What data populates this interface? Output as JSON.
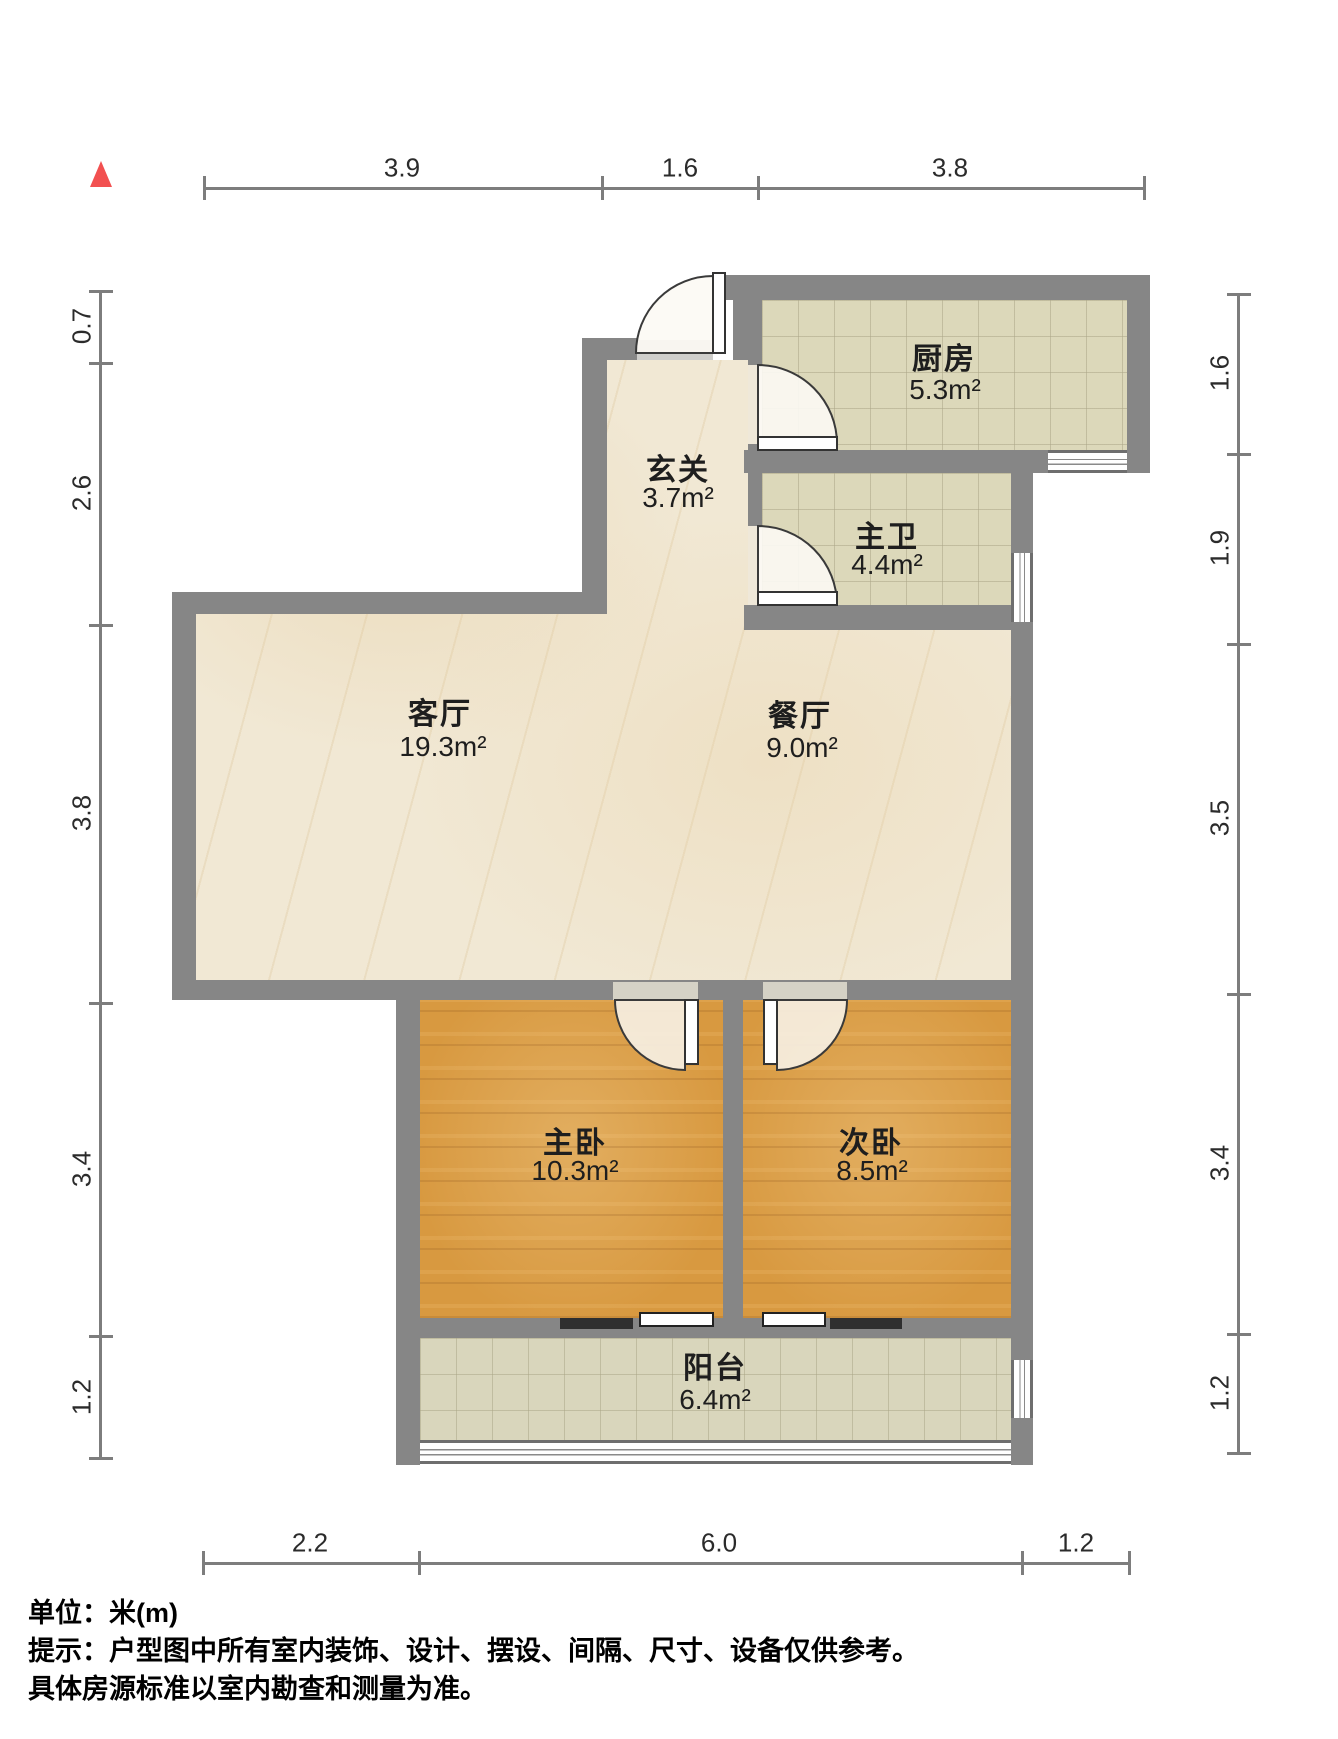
{
  "title": "户型图",
  "unit_note": "单位：米(m)",
  "rooms": [
    {
      "id": "entry",
      "name": "玄关",
      "area": "3.7m²"
    },
    {
      "id": "kitchen",
      "name": "厨房",
      "area": "5.3m²"
    },
    {
      "id": "master-bath",
      "name": "主卫",
      "area": "4.4m²"
    },
    {
      "id": "living-room",
      "name": "客厅",
      "area": "19.3m²"
    },
    {
      "id": "dining-room",
      "name": "餐厅",
      "area": "9.0m²"
    },
    {
      "id": "master-bedroom",
      "name": "主卧",
      "area": "10.3m²"
    },
    {
      "id": "second-bedroom",
      "name": "次卧",
      "area": "8.5m²"
    },
    {
      "id": "balcony",
      "name": "阳台",
      "area": "6.4m²"
    }
  ],
  "dimensions": {
    "top": [
      "3.9",
      "1.6",
      "3.8"
    ],
    "bottom": [
      "2.2",
      "6.0",
      "1.2"
    ],
    "left": [
      "0.7",
      "2.6",
      "3.8",
      "3.4",
      "1.2"
    ],
    "right": [
      "1.6",
      "1.9",
      "3.5",
      "3.4",
      "1.2"
    ]
  },
  "footer": {
    "line1": "单位：米(m)",
    "line2": "提示：户型图中所有室内装饰、设计、摆设、间隔、尺寸、设备仅供参考。",
    "line3": "具体房源标准以室内勘查和测量为准。"
  },
  "icons": {
    "north_indicator": "north-arrow-icon"
  },
  "colors": {
    "wall": "#868686",
    "marble_floor": "#f1e8d4",
    "tile_floor": "#dcd8ba",
    "wood_floor": "#d89940",
    "north_arrow": "#f25050",
    "dimension_line": "#7d7d7d",
    "text": "#1e1e1e"
  }
}
